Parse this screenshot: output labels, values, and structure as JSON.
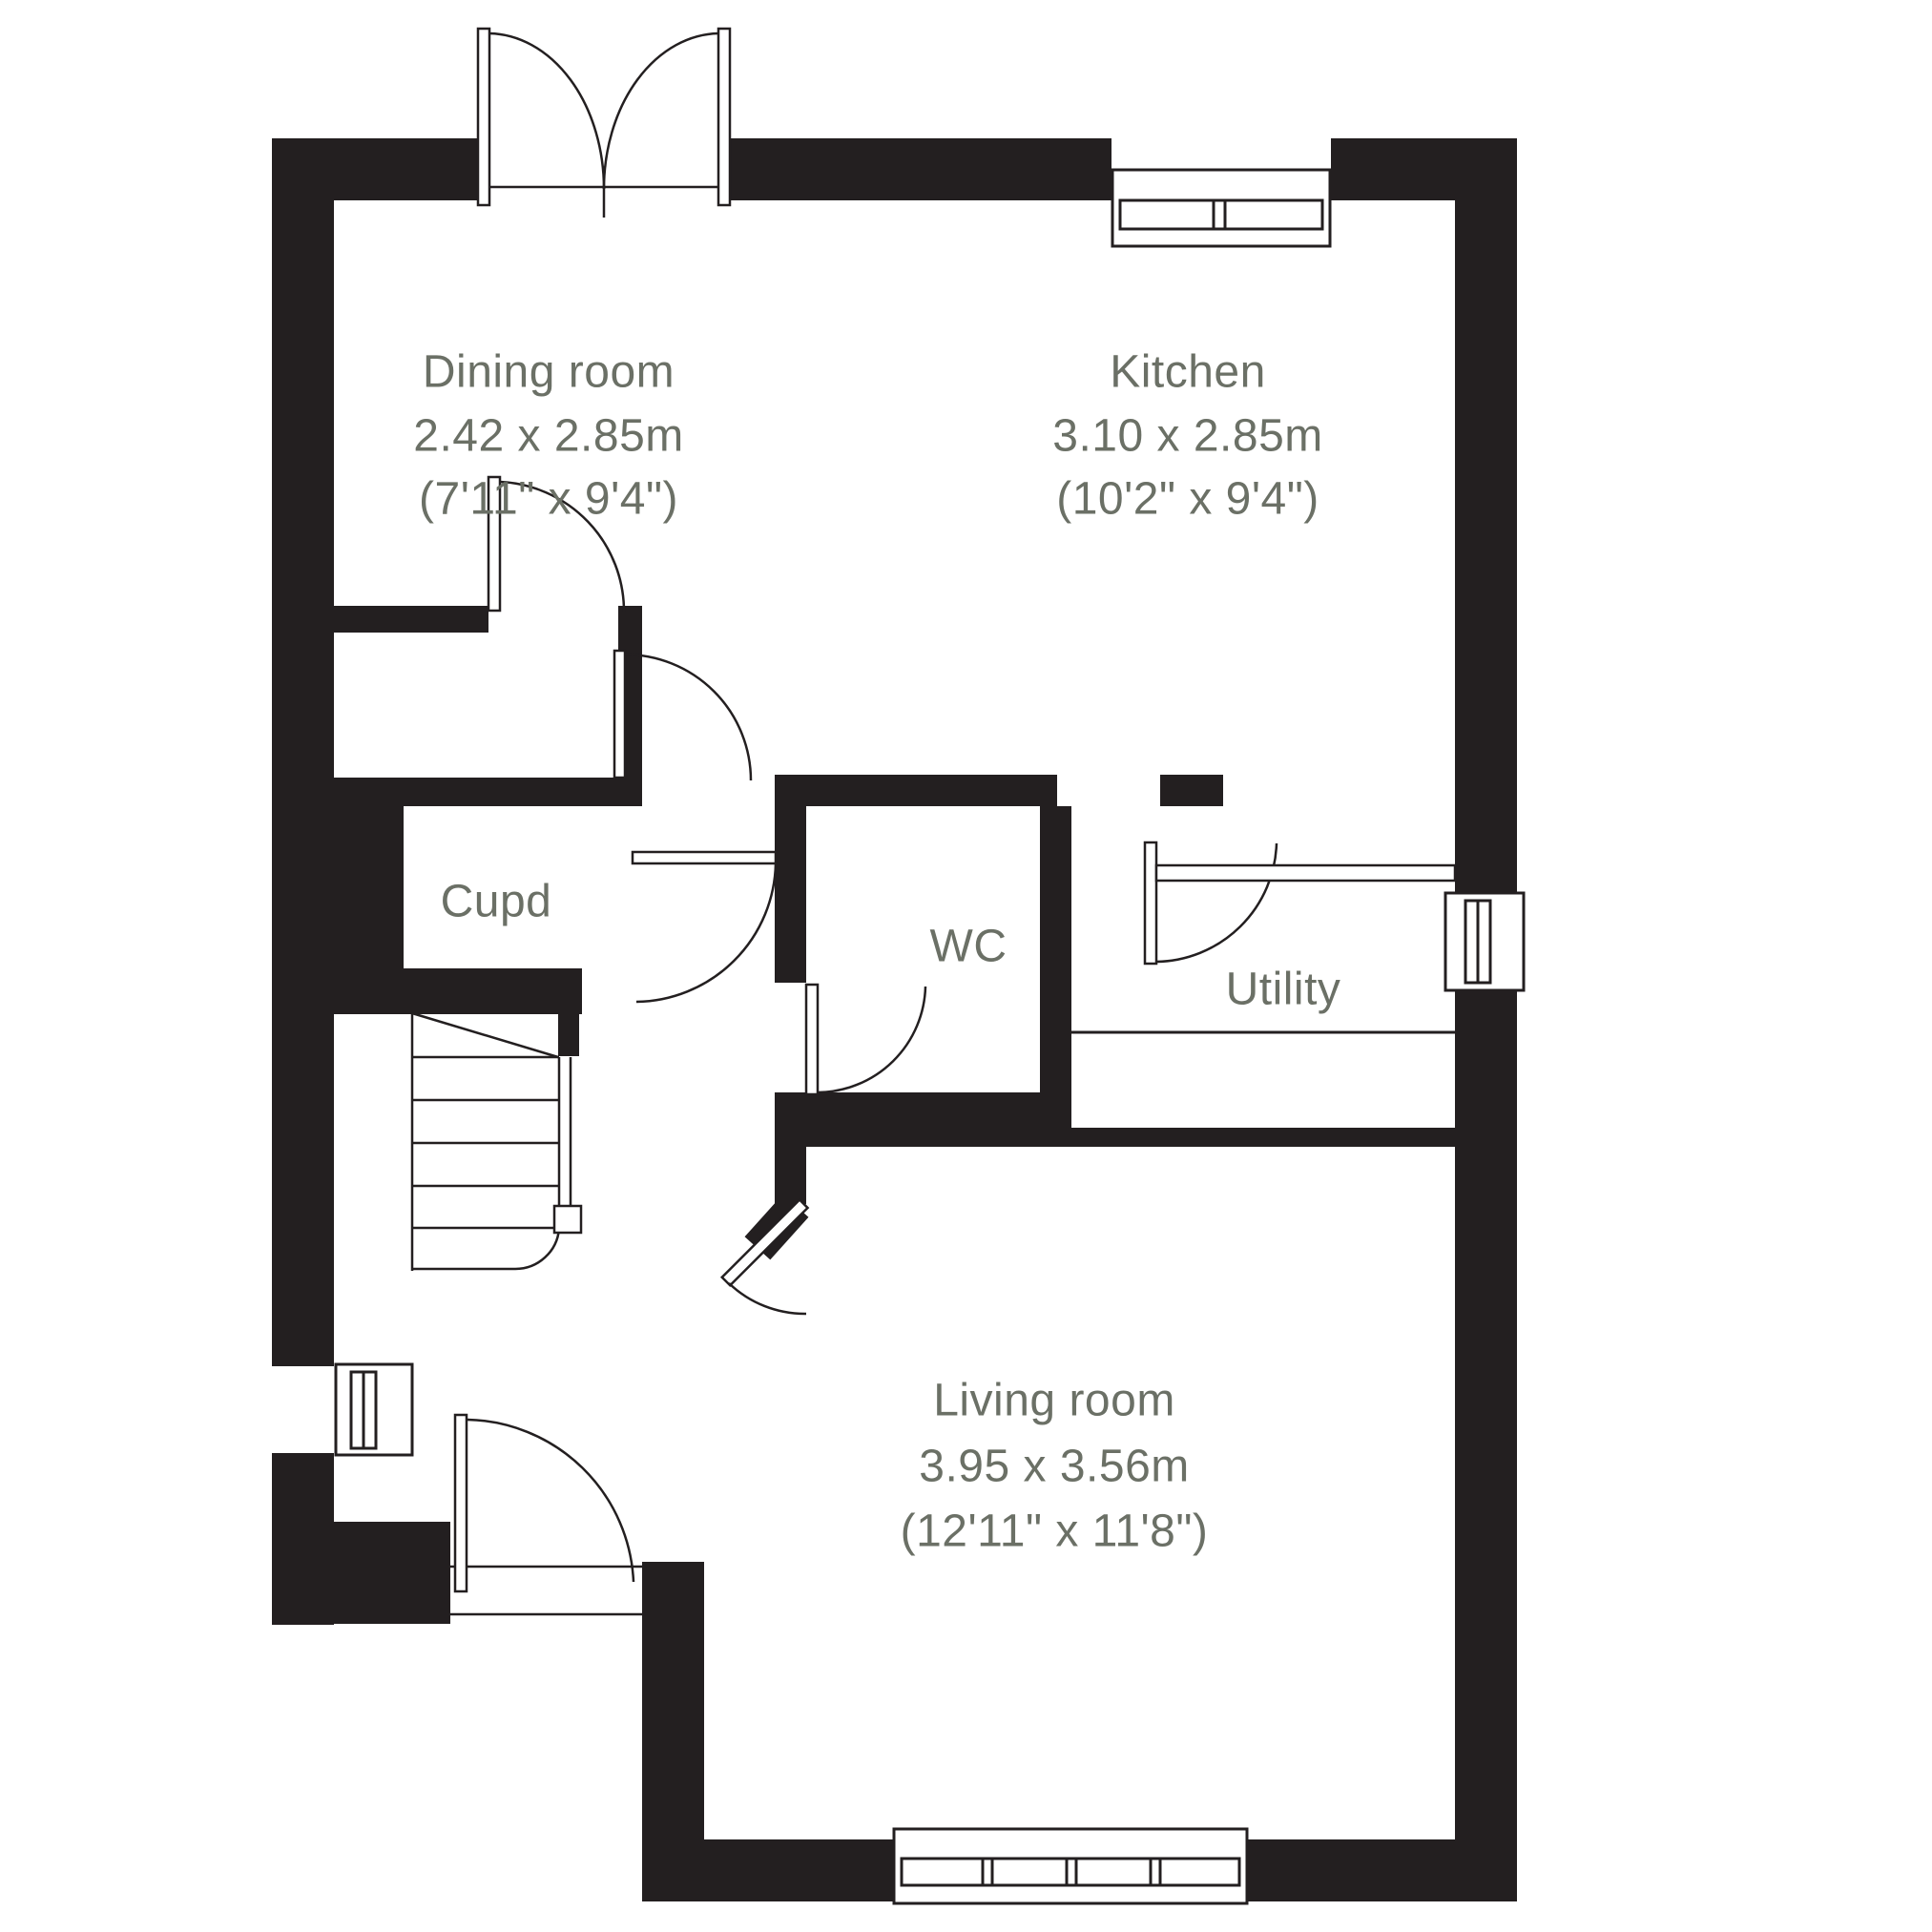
{
  "colors": {
    "wall": "#231f20",
    "line": "#231f20",
    "label": "#6b7066",
    "background": "#ffffff"
  },
  "rooms": [
    {
      "id": "dining",
      "name": "Dining room",
      "metric": "2.42 x 2.85m",
      "imperial": "(7'11\" x 9'4\")"
    },
    {
      "id": "kitchen",
      "name": "Kitchen",
      "metric": "3.10 x 2.85m",
      "imperial": "(10'2\" x 9'4\")"
    },
    {
      "id": "cupd",
      "name": "Cupd"
    },
    {
      "id": "wc",
      "name": "WC"
    },
    {
      "id": "utility",
      "name": "Utility"
    },
    {
      "id": "living",
      "name": "Living room",
      "metric": "3.95 x 3.56m",
      "imperial": "(12'11\" x 11'8\")"
    }
  ]
}
